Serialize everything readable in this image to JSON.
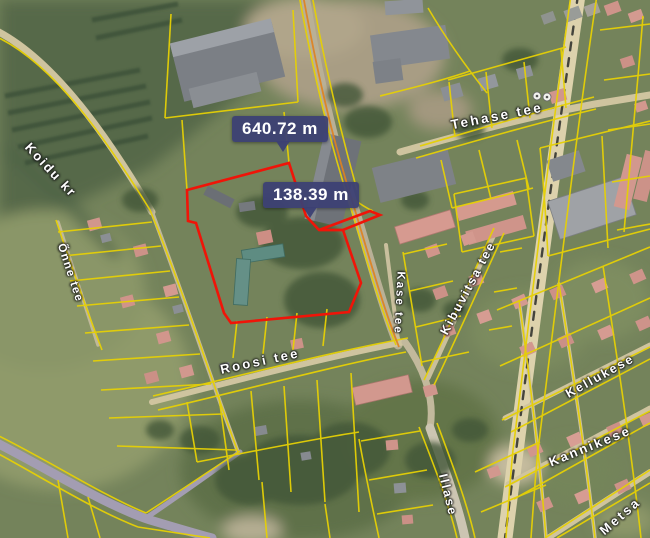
{
  "map": {
    "title": "satellite cadastral map with measurement overlay",
    "measurements": [
      {
        "id": "measure-1",
        "value": "640.72 m"
      },
      {
        "id": "measure-2",
        "value": "138.39 m"
      }
    ],
    "streets": [
      {
        "id": "tehase",
        "name": "Tehase tee"
      },
      {
        "id": "kibuvitsa",
        "name": "Kibuvitsa tee"
      },
      {
        "id": "kase",
        "name": "Kase tee"
      },
      {
        "id": "roosi",
        "name": "Roosi tee"
      },
      {
        "id": "koidu",
        "name": "Koidu kr"
      },
      {
        "id": "onne",
        "name": "Õnne tee"
      },
      {
        "id": "kellukese",
        "name": "Kellukese"
      },
      {
        "id": "kannikese",
        "name": "Kannikese"
      },
      {
        "id": "illase",
        "name": "Illase"
      },
      {
        "id": "metsa",
        "name": "Metsa"
      }
    ],
    "symbols": [
      "map-point-symbol",
      "map-point-symbol"
    ],
    "colors": {
      "parcel_highlight": "#f01408",
      "cadastral_line": "#e6d005",
      "road_accent_line": "#e0821e",
      "measure_badge_bg": "#3c4074",
      "measure_badge_text": "#ffffff",
      "street_label_text": "#ffffff"
    }
  }
}
